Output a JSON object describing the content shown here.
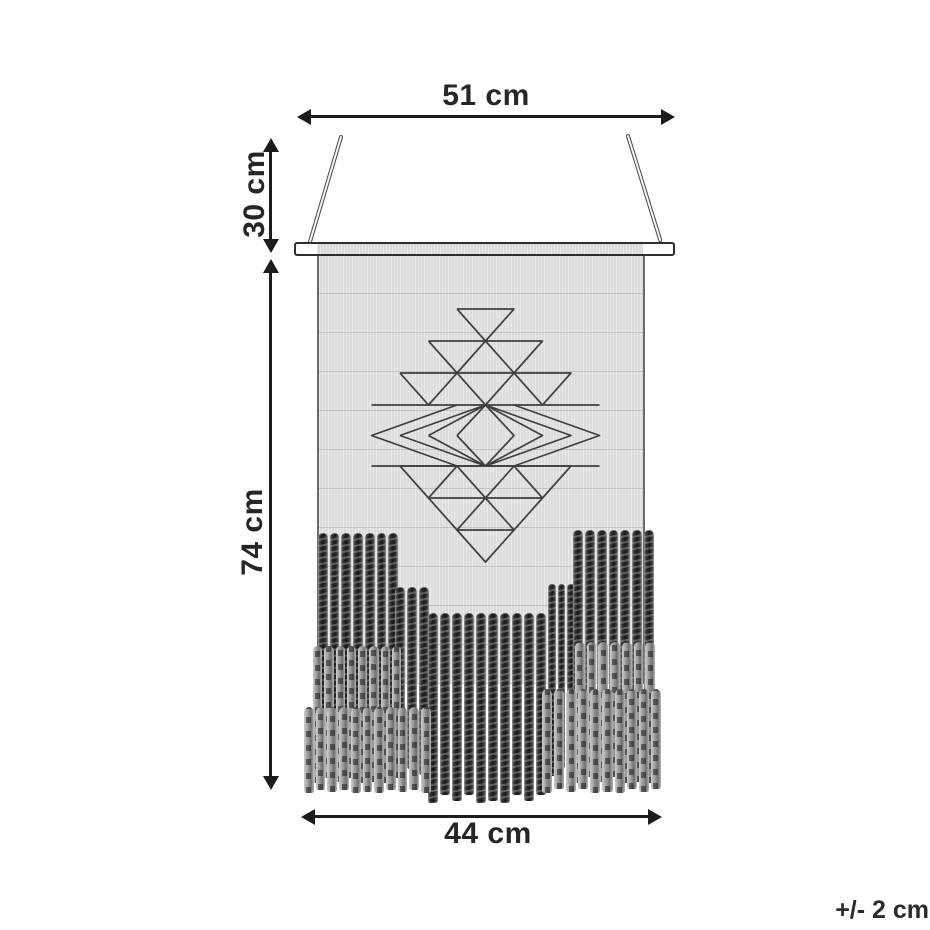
{
  "diagram": {
    "dimensions": {
      "top_width": "51 cm",
      "hanging_height": "30 cm",
      "body_height": "74 cm",
      "bottom_width": "44 cm"
    },
    "tolerance_note": "+/- 2 cm"
  },
  "colors": {
    "ink": "#1c1c1c",
    "label_text": "#262626",
    "fabric": "#dcdcdc",
    "motif_stroke": "#3f3f3f",
    "cord_dark": "#1d1d1d",
    "cord_gray": "#9b9b9b",
    "background": "#ffffff"
  },
  "artwork": {
    "motif": {
      "cx": 485.5,
      "unit": 28.5,
      "row_height": 32,
      "rows_up": [
        {
          "count": 1,
          "base_y": 309
        },
        {
          "count": 2,
          "base_y": 341
        },
        {
          "count": 3,
          "base_y": 373
        }
      ],
      "band": {
        "top_y": 405,
        "bottom_y": 466,
        "left_x": 371.5,
        "right_x": 599.5,
        "diamond_half_widths": [
          28.5,
          57,
          85.5
        ]
      },
      "rows_down": [
        {
          "count": 3,
          "base_y": 466
        },
        {
          "count": 2,
          "base_y": 498
        },
        {
          "count": 1,
          "base_y": 530
        }
      ]
    },
    "fringe_tiers": [
      {
        "x": 318,
        "y": 533,
        "w": 80,
        "h": 239,
        "cords": 7,
        "tone": "dark"
      },
      {
        "x": 395,
        "y": 587,
        "w": 34,
        "h": 190,
        "cords": 3,
        "tone": "dark"
      },
      {
        "x": 548,
        "y": 584,
        "w": 27,
        "h": 192,
        "cords": 3,
        "tone": "dark"
      },
      {
        "x": 573,
        "y": 530,
        "w": 81,
        "h": 242,
        "cords": 7,
        "tone": "dark"
      },
      {
        "x": 428,
        "y": 613,
        "w": 118,
        "h": 190,
        "cords": 10,
        "tone": "dark"
      },
      {
        "x": 313,
        "y": 646,
        "w": 88,
        "h": 137,
        "cords": 8,
        "tone": "gray"
      },
      {
        "x": 575,
        "y": 642,
        "w": 80,
        "h": 141,
        "cords": 7,
        "tone": "gray"
      },
      {
        "x": 304,
        "y": 707,
        "w": 127,
        "h": 86,
        "cords": 11,
        "tone": "gray"
      },
      {
        "x": 542,
        "y": 689,
        "w": 119,
        "h": 104,
        "cords": 10,
        "tone": "gray"
      }
    ]
  }
}
